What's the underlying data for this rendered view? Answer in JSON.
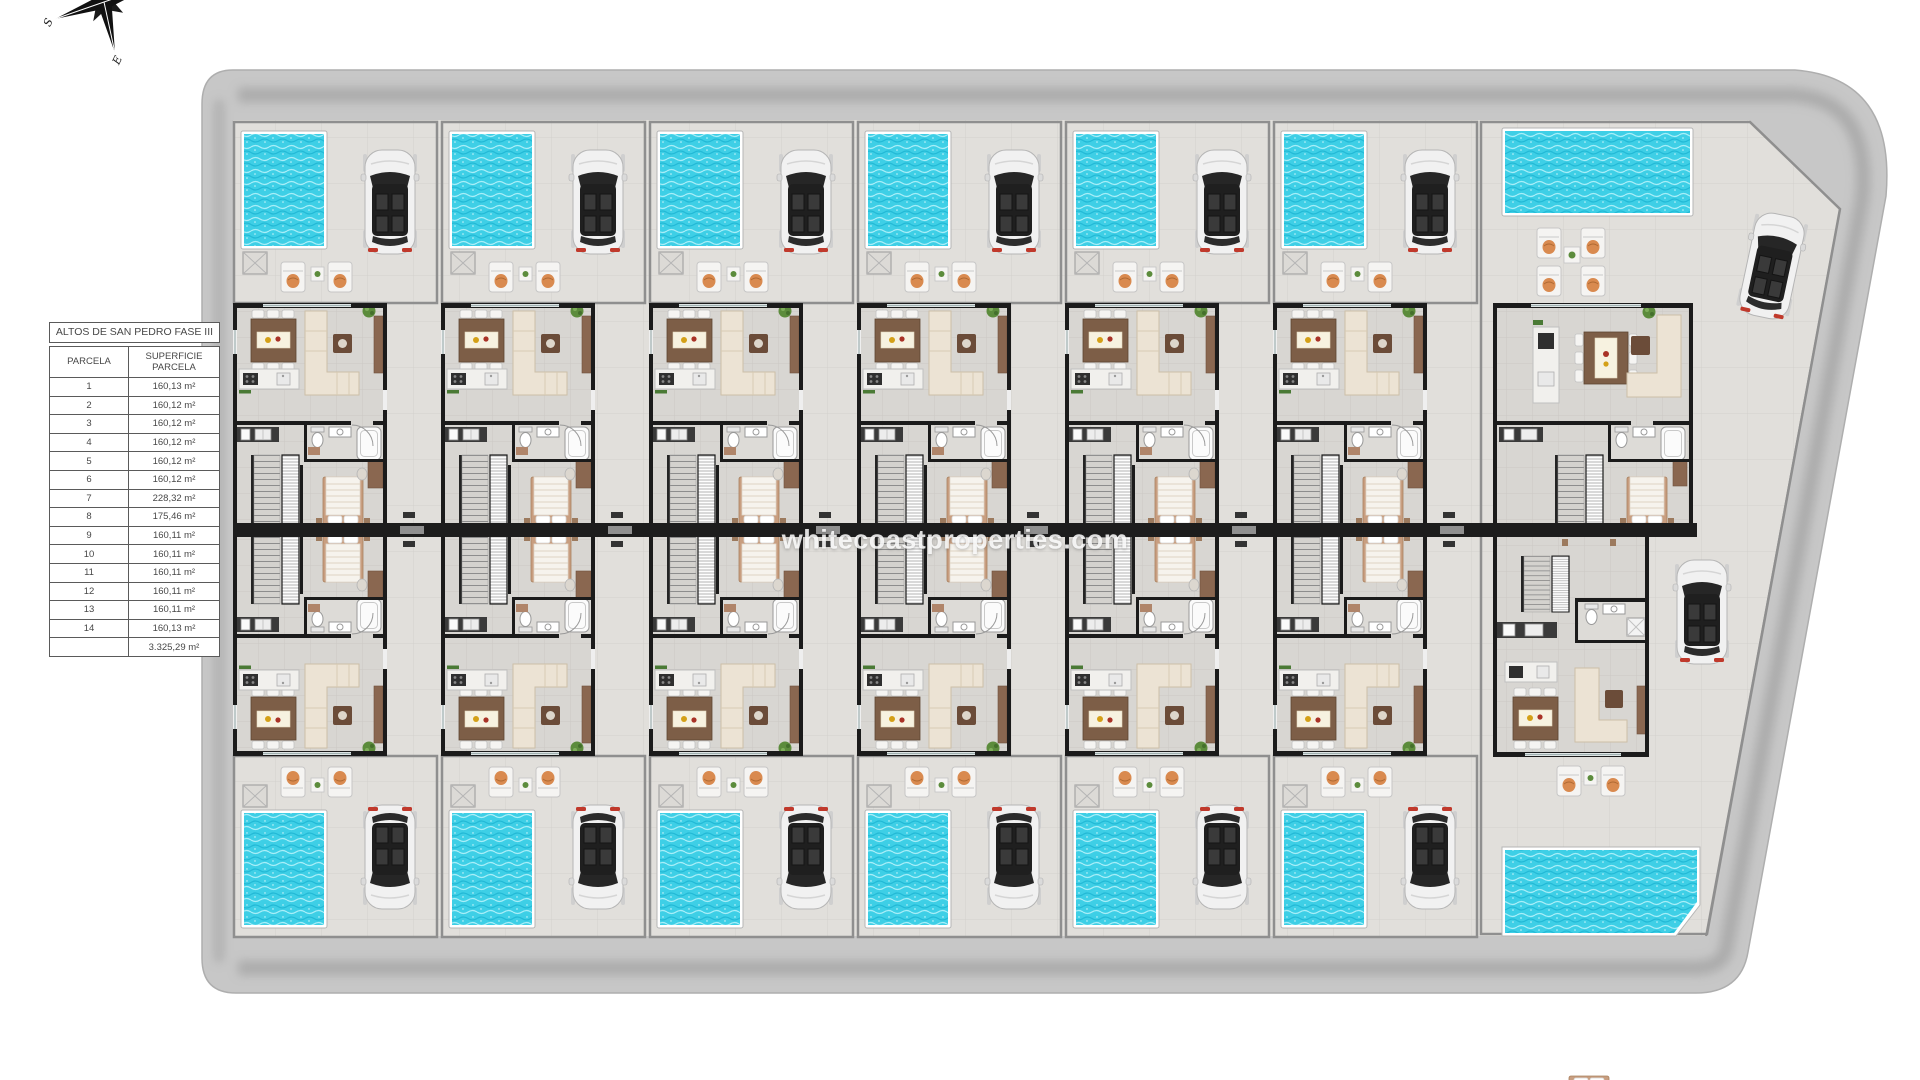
{
  "site": {
    "watermark": "whitecoastproperties.com",
    "compass": {
      "south_label": "S",
      "east_label": "E"
    }
  },
  "table": {
    "title": "ALTOS DE SAN PEDRO FASE III",
    "columns": [
      "PARCELA",
      "SUPERFICIE PARCELA"
    ],
    "rows": [
      [
        "1",
        "160,13 m²"
      ],
      [
        "2",
        "160,12 m²"
      ],
      [
        "3",
        "160,12 m²"
      ],
      [
        "4",
        "160,12 m²"
      ],
      [
        "5",
        "160,12 m²"
      ],
      [
        "6",
        "160,12 m²"
      ],
      [
        "7",
        "228,32 m²"
      ],
      [
        "8",
        "175,46 m²"
      ],
      [
        "9",
        "160,11 m²"
      ],
      [
        "10",
        "160,11 m²"
      ],
      [
        "11",
        "160,11 m²"
      ],
      [
        "12",
        "160,11 m²"
      ],
      [
        "13",
        "160,11 m²"
      ],
      [
        "14",
        "160,13 m²"
      ]
    ],
    "total": "3.325,29 m²"
  },
  "plan": {
    "unit_columns": 7,
    "units_total": 14,
    "features": [
      "pool",
      "car",
      "sun-loungers",
      "outdoor-shower",
      "dining-set",
      "sofa",
      "kitchen",
      "bathroom",
      "stairs",
      "bedroom",
      "party-wall",
      "perimeter-road"
    ],
    "colors": {
      "pool_water": "#3ecfe6",
      "pool_water_dark": "#22b9d6",
      "road": "#c7c7c7",
      "terrain": "#e1dfdb",
      "floor": "#d8d6d2",
      "wall": "#1b1b1b",
      "wood": "#7d5e47",
      "wood_light": "#8a6750",
      "sofa": "#ece3d4",
      "accent_orange": "#d98a4f",
      "plant_green": "#5c8c3c"
    }
  }
}
